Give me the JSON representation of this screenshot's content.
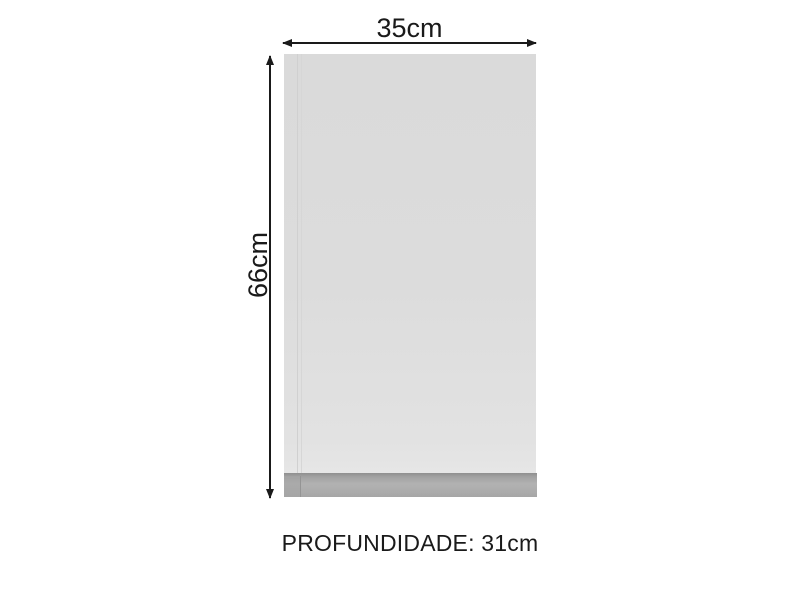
{
  "diagram": {
    "title": "cabinet-dimension-diagram",
    "width_label": "35cm",
    "height_label": "66cm",
    "depth_label": "PROFUNDIDADE: 31cm"
  },
  "colors": {
    "background": "#ffffff",
    "cabinet_body": "#dcdcdc",
    "cabinet_body_light": "#e6e6e6",
    "cabinet_seam": "#d0d0d0",
    "plinth_band": "#ababab",
    "plinth_line": "#8f8f8f",
    "arrow": "#1a1a1a",
    "text": "#1a1a1a"
  }
}
